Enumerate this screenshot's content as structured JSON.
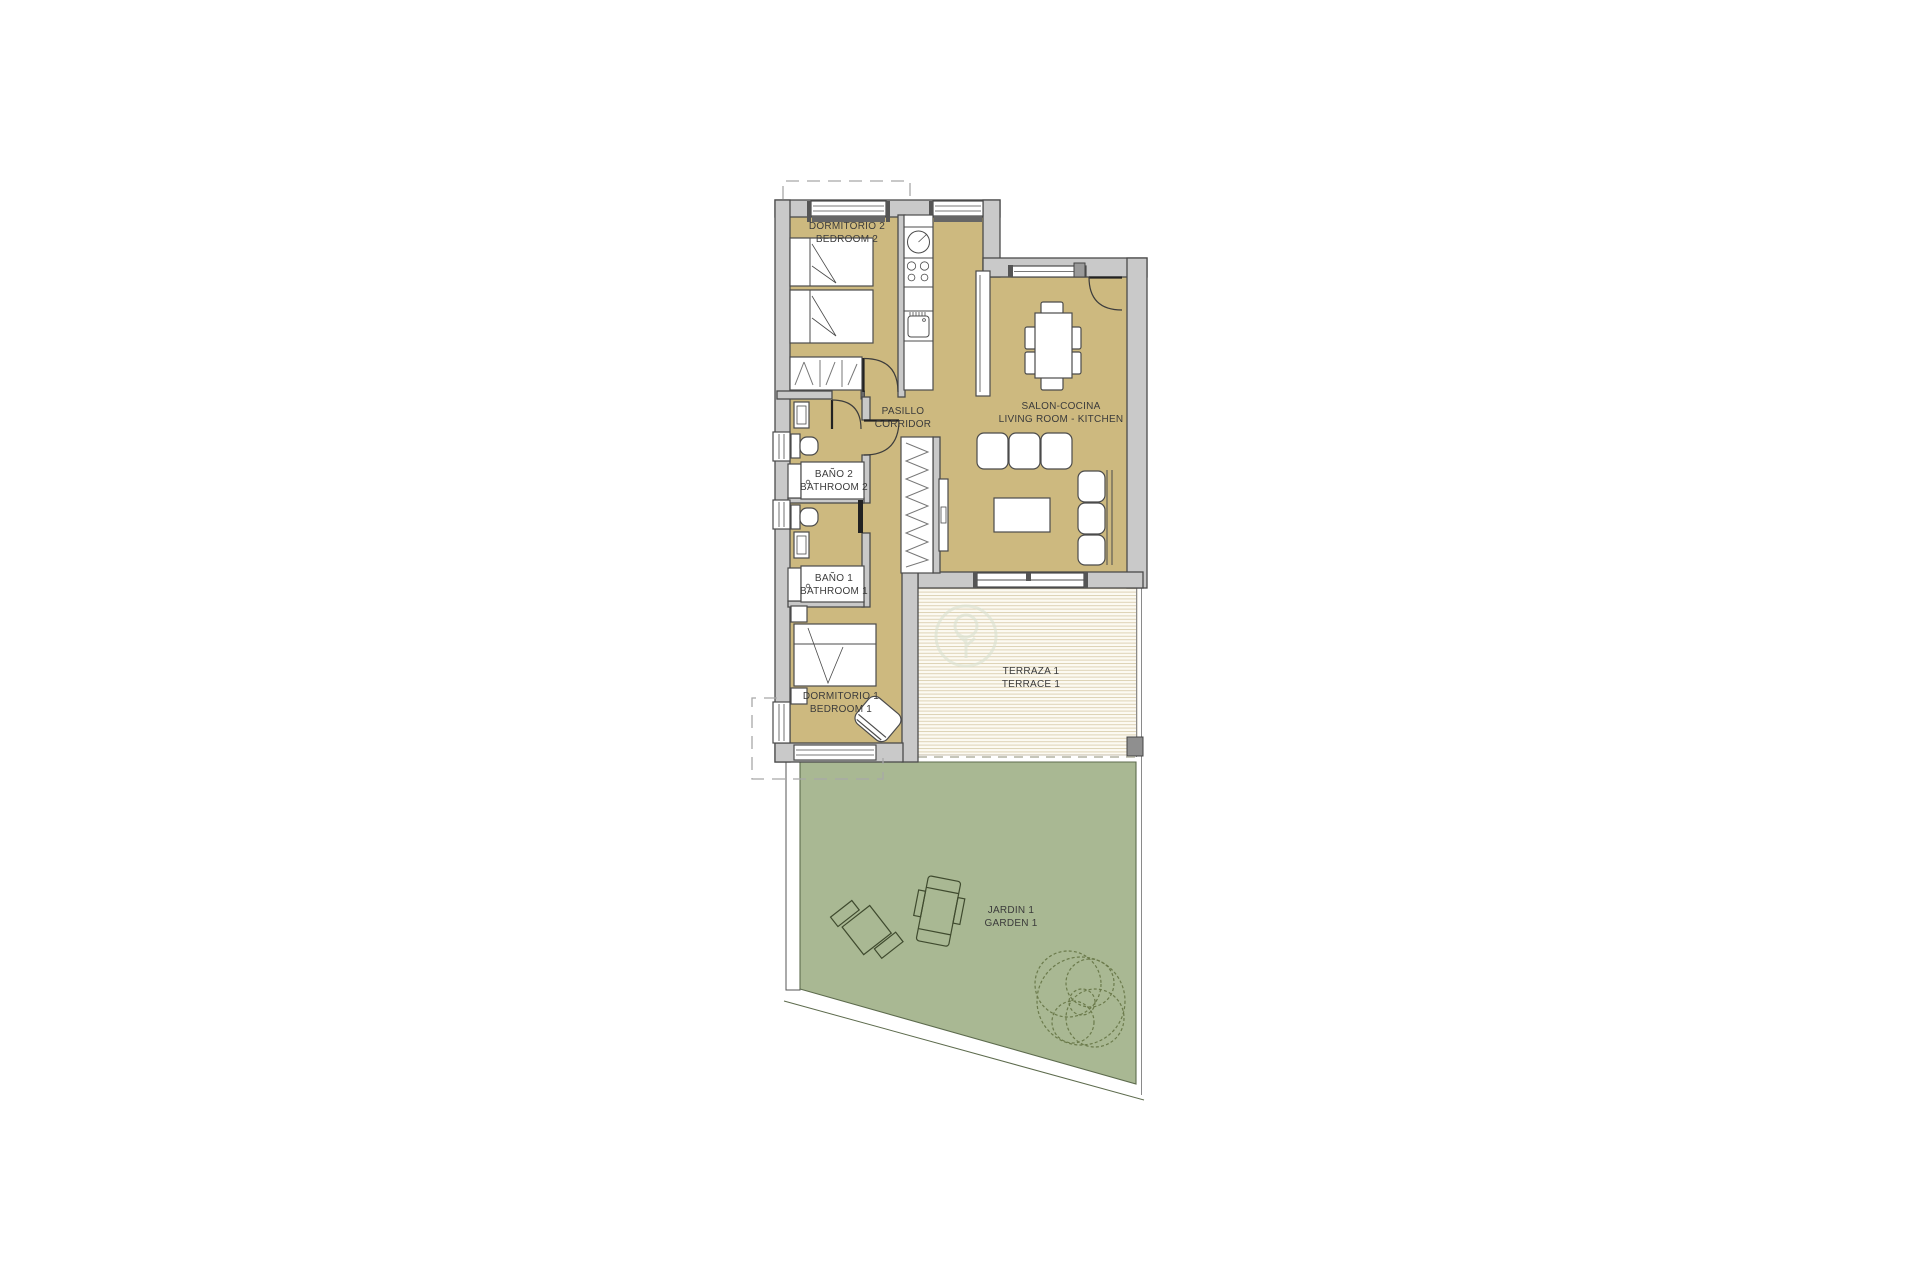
{
  "title": "Floor plan",
  "colors": {
    "floor": "#cdb97f",
    "wall_fill": "#c9c9c9",
    "wall_edge": "#4b4b4b",
    "line": "#4b4b4b",
    "garden": "#a9b893",
    "garden_edge": "#5d6b4d",
    "tree_line": "#6b7a4b",
    "furniture_garden_line": "#3f4a2e",
    "terrace_bg": "#fcfaf2",
    "terrace_stripe": "#ded3b6",
    "text": "#3b3b3b",
    "dashed": "#a8a8a8",
    "boundary_dashed": "#b3b3a4",
    "watermark": "#dce2d2"
  },
  "rooms": {
    "bedroom2": {
      "line1": "DORMITORIO 2",
      "line2": "BEDROOM 2"
    },
    "corridor": {
      "line1": "PASILLO",
      "line2": "CORRIDOR"
    },
    "living": {
      "line1": "SALON-COCINA",
      "line2": "LIVING ROOM - KITCHEN"
    },
    "bath2": {
      "line1": "BAÑO 2",
      "line2": "BATHROOM 2"
    },
    "bath1": {
      "line1": "BAÑO 1",
      "line2": "BATHROOM 1"
    },
    "bedroom1": {
      "line1": "DORMITORIO 1",
      "line2": "BEDROOM 1"
    },
    "terrace": {
      "line1": "TERRAZA 1",
      "line2": "TERRACE 1"
    },
    "garden": {
      "line1": "JARDIN 1",
      "line2": "GARDEN 1"
    }
  }
}
